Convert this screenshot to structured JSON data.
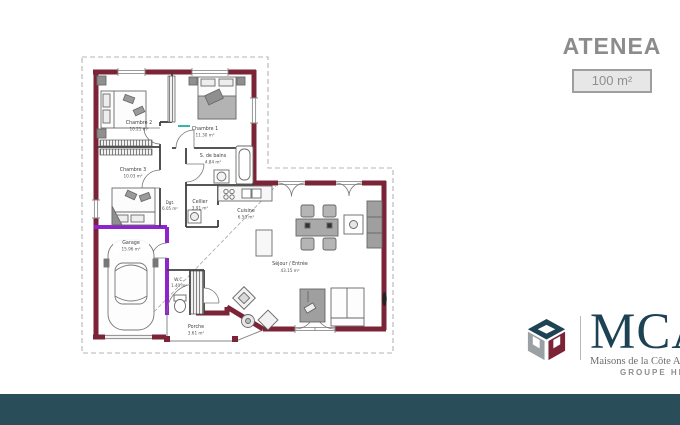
{
  "header": {
    "title": "ATENEA",
    "area_badge": "100 m²"
  },
  "branding": {
    "wordmark": "MCA",
    "tagline": "Maisons de la Côte Atlantique",
    "group_label": "GROUPE HEXAOM",
    "colors": {
      "brand_teal": "#1d4354",
      "brand_maroon": "#7b2437",
      "brand_gray": "#9aa0a4",
      "footer_bar": "#2a4d5a"
    }
  },
  "plan": {
    "colors": {
      "wall": "#7b2437",
      "garage_highlight": "#8e24cc",
      "roof_outline": "#b5b5b5",
      "lintel_teal": "#3bb3ad"
    },
    "rooms": {
      "chambre2": {
        "name": "Chambre 2",
        "area": "10.21 m²"
      },
      "chambre1": {
        "name": "Chambre 1",
        "area": "11.30 m²"
      },
      "chambre3": {
        "name": "Chambre 3",
        "area": "10.03 m²"
      },
      "sdb": {
        "name": "S. de bains",
        "area": "4.84 m²"
      },
      "dgt": {
        "name": "Dgt.",
        "area": "6.05 m²"
      },
      "cellier": {
        "name": "Cellier",
        "area": "3.91 m²"
      },
      "cuisine": {
        "name": "Cuisine",
        "area": "6.50 m²"
      },
      "sejour": {
        "name": "Séjour / Entrée",
        "area": "43.15 m²"
      },
      "wc": {
        "name": "W.C.",
        "area": "1.40 m²"
      },
      "garage": {
        "name": "Garage",
        "area": "15.96 m²"
      },
      "porche": {
        "name": "Porche",
        "area": "3.61 m²"
      }
    }
  }
}
